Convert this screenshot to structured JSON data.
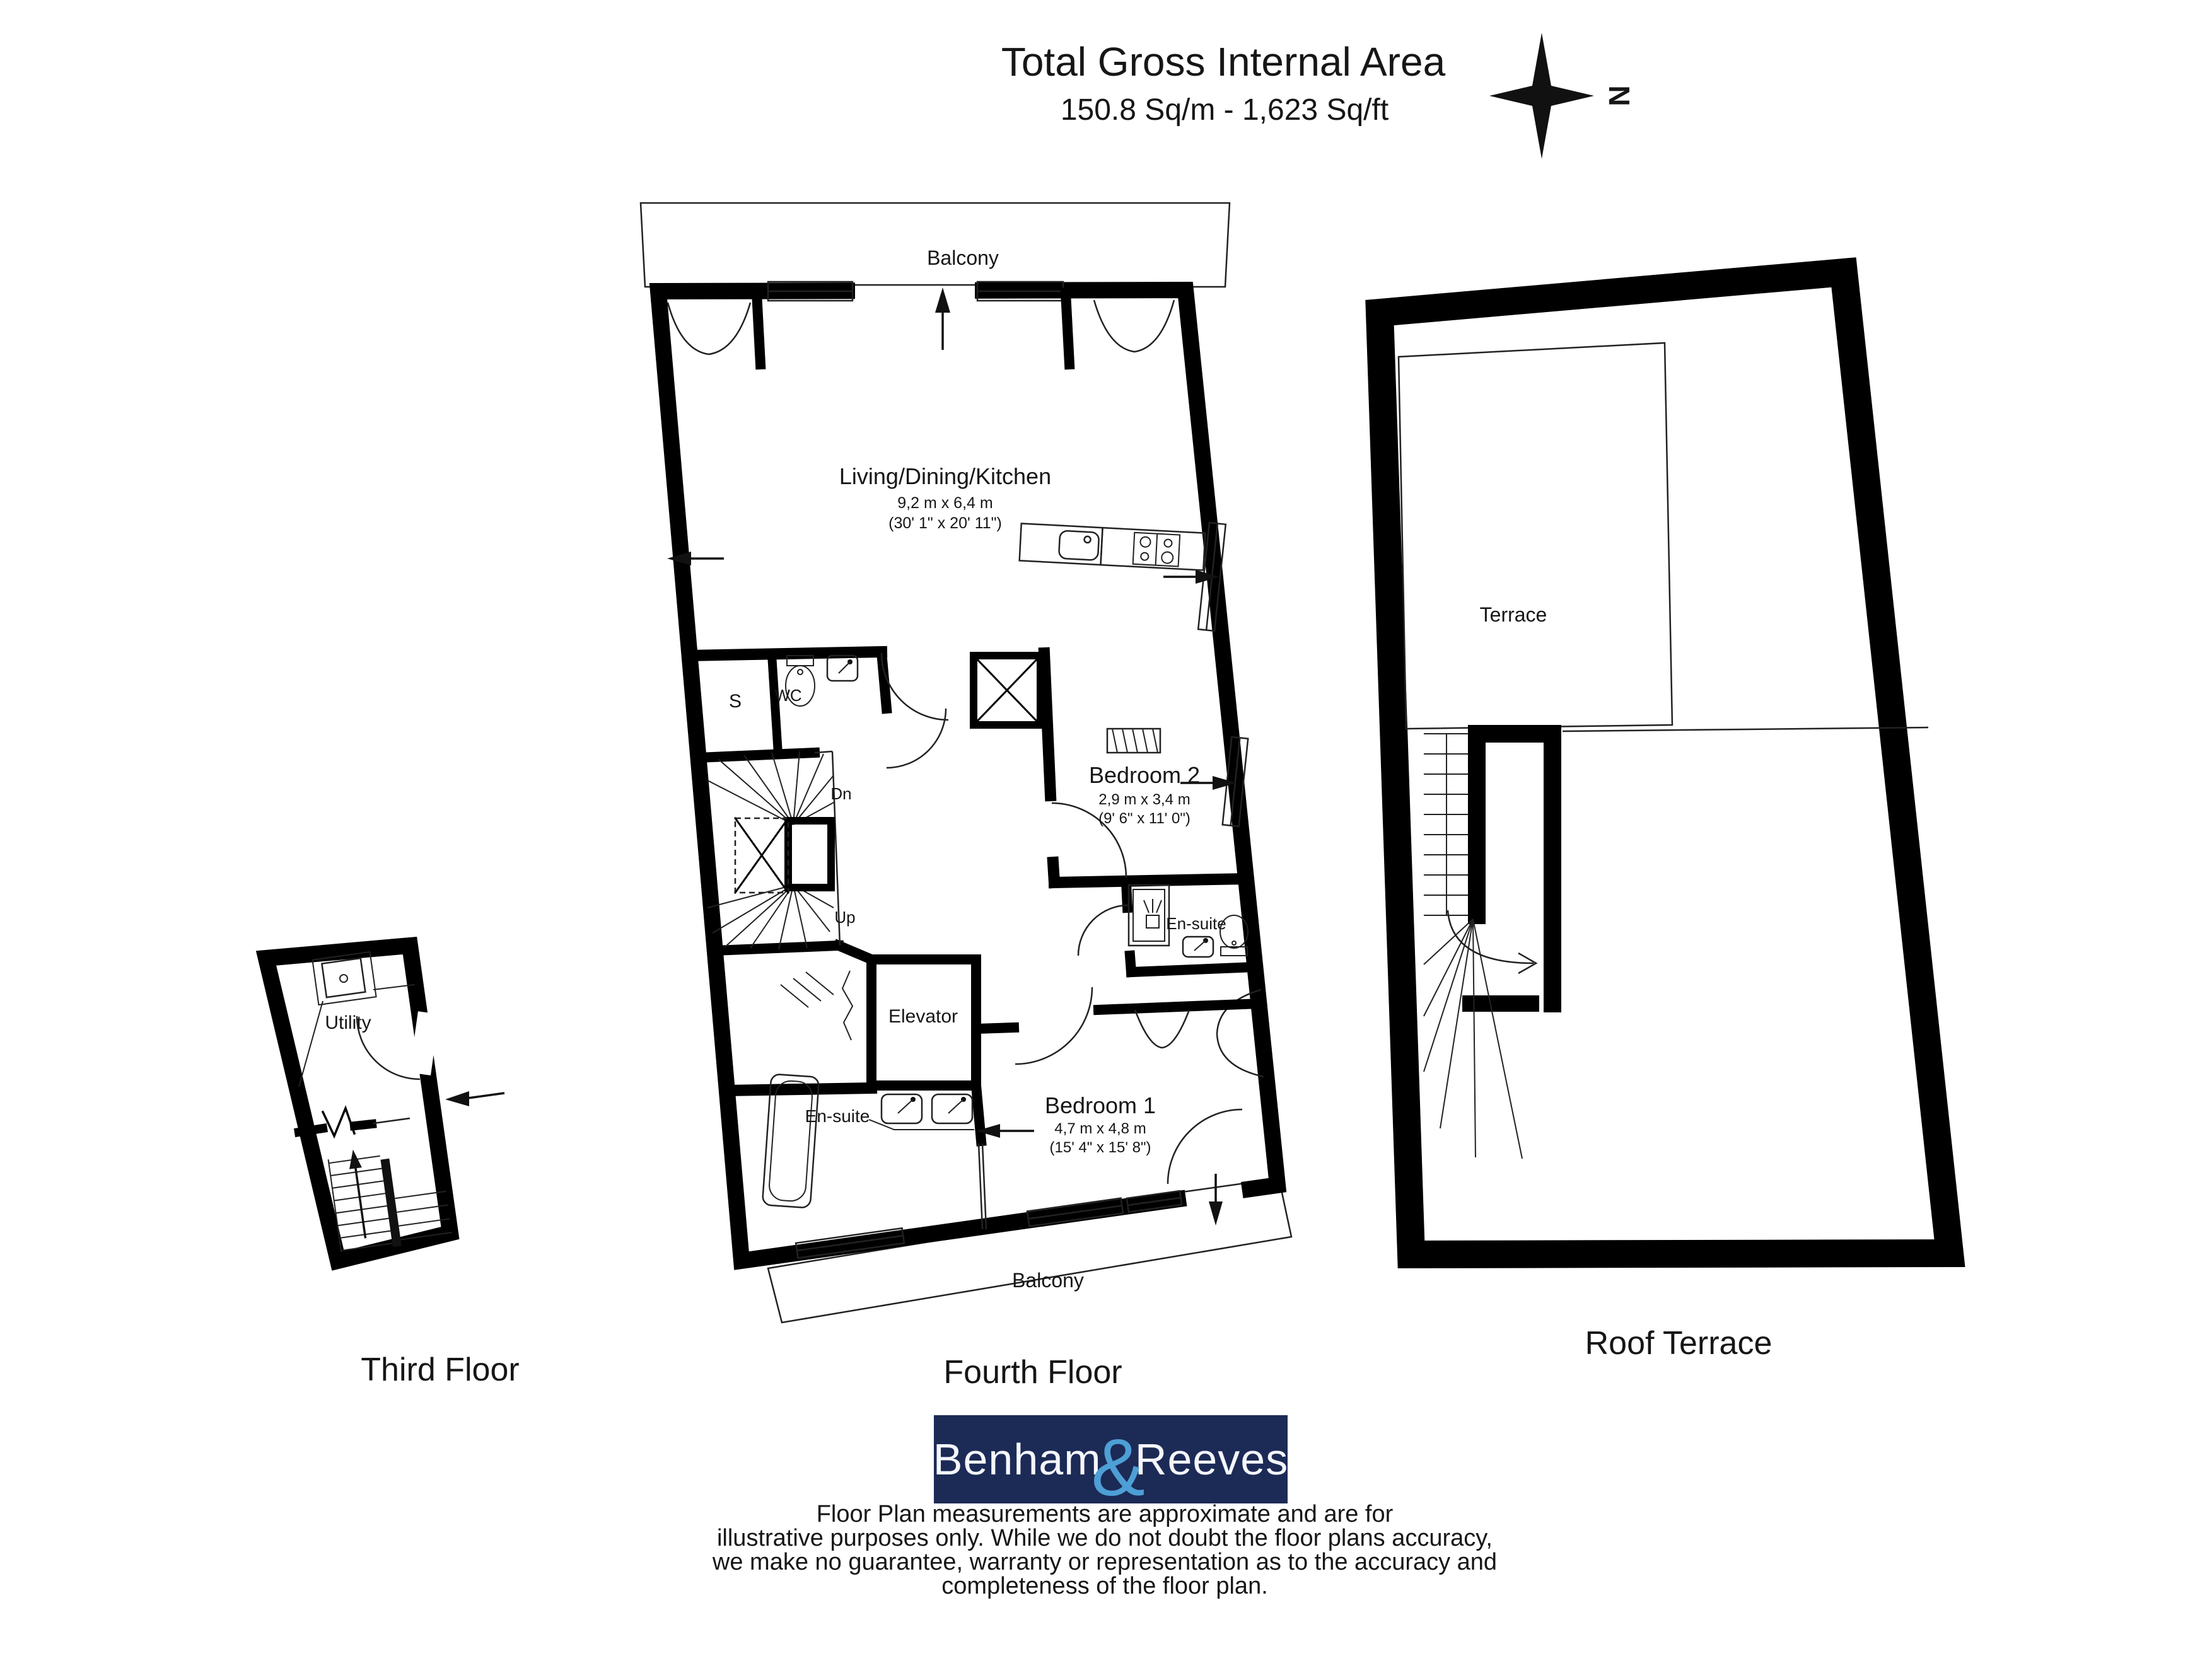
{
  "header": {
    "title": "Total Gross Internal Area",
    "subtitle": "150.8 Sq/m - 1,623 Sq/ft",
    "compass_letter": "N"
  },
  "floors": {
    "third": {
      "name": "Third Floor",
      "utility": "Utility"
    },
    "fourth": {
      "name": "Fourth Floor",
      "balcony_top": "Balcony",
      "balcony_bottom": "Balcony",
      "living": {
        "name": "Living/Dining/Kitchen",
        "metric": "9,2 m x 6,4 m",
        "imperial": "(30' 1\" x 20' 11\")"
      },
      "bedroom2": {
        "name": "Bedroom 2",
        "metric": "2,9 m x 3,4 m",
        "imperial": "(9' 6\" x 11' 0\")"
      },
      "bedroom1": {
        "name": "Bedroom 1",
        "metric": "4,7 m x 4,8 m",
        "imperial": "(15' 4\" x 15' 8\")"
      },
      "ensuite_left": "En-suite",
      "ensuite_right": "En-suite",
      "storage": "S",
      "wc": "WC",
      "elevator": "Elevator",
      "stairs_down": "Dn",
      "stairs_up": "Up"
    },
    "roof": {
      "name": "Roof Terrace",
      "terrace": "Terrace"
    }
  },
  "logo": {
    "part1": "Benham",
    "amp": "&",
    "part2": "Reeves",
    "bg_color": "#1c2a56",
    "amp_color": "#4d9fd6"
  },
  "disclaimer": {
    "line1": "Floor Plan measurements are approximate and are for",
    "line2": "illustrative purposes only.  While we do not doubt the floor plans accuracy,",
    "line3": "we make no guarantee, warranty or representation as to the accuracy and",
    "line4": "completeness of the floor plan."
  }
}
